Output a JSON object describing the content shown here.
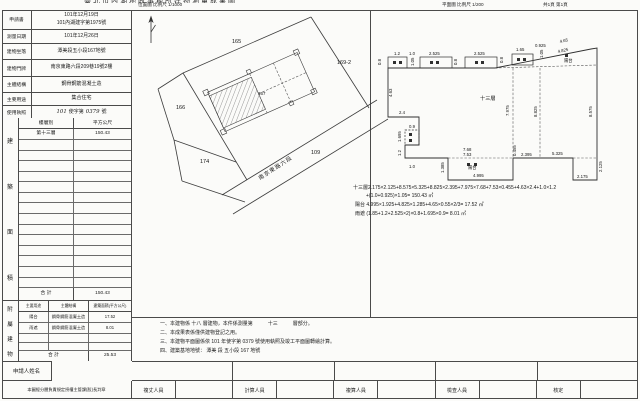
{
  "header": {
    "clipped_title": "臺北市內湖地政事務所建物測量成果圖",
    "location_map_title": "位置圖 比例尺 1/1000",
    "plan_title": "平面圖 比例尺 1/200",
    "page_info": "共1頁 第1頁"
  },
  "info": {
    "application": {
      "label": "申請書",
      "date": "101年12月19日",
      "doc_no": "101內湖建字第1975號"
    },
    "survey_date": {
      "label": "測量日期",
      "value": "101年12月26日"
    },
    "site": {
      "label": "建物坐落",
      "value": "潭美段五小段167地號"
    },
    "address": {
      "label": "建物門牌",
      "value": "南京東路六段209巷19號2樓"
    },
    "structure": {
      "label": "主體結構",
      "value": "鋼骨鋼筋混凝土造"
    },
    "usage": {
      "label": "主要用途",
      "value": "集合住宅"
    },
    "permit": {
      "label": "使用執照",
      "year": "101",
      "mid": "使字第",
      "no": "0379",
      "suffix": "號"
    }
  },
  "floor_area": {
    "side_label": "建築面積",
    "col_floor": "樓層別",
    "col_area": "平方公尺",
    "rows": [
      {
        "floor": "第十三層",
        "area": "150.43"
      }
    ],
    "empty_rows": 14,
    "total_label": "合 計",
    "total": "150.43"
  },
  "annex": {
    "side_label": "附屬建物",
    "headers": [
      "主要用途",
      "主體結構",
      "建築面積(平方公尺)"
    ],
    "rows": [
      [
        "陽台",
        "鋼骨鋼筋混凝土造",
        "17.52"
      ],
      [
        "雨遮",
        "鋼骨鋼筋混凝土造",
        "8.01"
      ],
      [
        "",
        "",
        ""
      ],
      [
        "",
        "",
        ""
      ]
    ],
    "total_label": "合 計",
    "total": "25.53"
  },
  "applicant_label": "申請人姓名",
  "approval_note": "本圖經分層負責規定授權主管課(股)長判章",
  "signers": [
    "複丈人員",
    "計算人員",
    "複算人員",
    "檢查人員",
    "核定"
  ],
  "notes": [
    "一、本建物係 十八 層建物，本件係測量第　　　十三　　　層部分。",
    "二、本成果表係僅供建物登記之用。",
    "三、本建物平面圖係依 101 年使字第 0379 號使用執照及竣工平面圖轉繪計算。",
    "四、建築基地地號： 潭美 段 五小段 167 地號"
  ],
  "location_map": {
    "labels": [
      {
        "t": "165",
        "x": 100,
        "y": 33,
        "cls": "maptxt"
      },
      {
        "t": "169-2",
        "x": 205,
        "y": 54,
        "cls": "maptxt"
      },
      {
        "t": "166",
        "x": 44,
        "y": 99,
        "cls": "maptxt"
      },
      {
        "t": "174",
        "x": 68,
        "y": 153,
        "cls": "maptxt"
      },
      {
        "t": "109",
        "x": 179,
        "y": 144,
        "cls": "maptxt"
      },
      {
        "t": "167",
        "x": 126,
        "y": 85,
        "cls": "sm"
      },
      {
        "t": "南京東路六段",
        "x": 128,
        "y": 170,
        "r": -33,
        "cls": "road"
      }
    ]
  },
  "floor_plan": {
    "labels": [
      {
        "t": "0.8",
        "x": 13,
        "y": 47,
        "r": -90
      },
      {
        "t": "1.2",
        "x": 26,
        "y": 37
      },
      {
        "t": "1.0",
        "x": 41,
        "y": 37
      },
      {
        "t": "1.05",
        "x": 46,
        "y": 48,
        "r": -90
      },
      {
        "t": "2.525",
        "x": 61,
        "y": 37
      },
      {
        "t": "0.8",
        "x": 89,
        "y": 47,
        "r": -90
      },
      {
        "t": "2.525",
        "x": 106,
        "y": 37
      },
      {
        "t": "0.8",
        "x": 135,
        "y": 45,
        "r": -90
      },
      {
        "t": "1.65",
        "x": 148,
        "y": 33
      },
      {
        "t": "0.925",
        "x": 167,
        "y": 29
      },
      {
        "t": "1.05",
        "x": 175,
        "y": 40,
        "r": -90
      },
      {
        "t": "4.65",
        "x": 192,
        "y": 25,
        "r": -12
      },
      {
        "t": "4.825",
        "x": 190,
        "y": 35,
        "r": -12
      },
      {
        "t": "陽台",
        "x": 196,
        "y": 44,
        "cls": "cj"
      },
      {
        "t": "8.575",
        "x": 224,
        "y": 99,
        "r": -90
      },
      {
        "t": "4.63",
        "x": 24,
        "y": 79,
        "r": -90
      },
      {
        "t": "2.4",
        "x": 31,
        "y": 96
      },
      {
        "t": "0.9",
        "x": 41,
        "y": 110
      },
      {
        "t": "1.695",
        "x": 33,
        "y": 124,
        "r": -90
      },
      {
        "t": "1.2",
        "x": 33,
        "y": 138,
        "r": -90
      },
      {
        "t": "1.0",
        "x": 41,
        "y": 150
      },
      {
        "t": "十三層",
        "x": 112,
        "y": 82,
        "cls": "big"
      },
      {
        "t": "7.975",
        "x": 141,
        "y": 98,
        "r": -90
      },
      {
        "t": "8.825",
        "x": 169,
        "y": 99,
        "r": -90
      },
      {
        "t": "1.385",
        "x": 76,
        "y": 155,
        "r": -90
      },
      {
        "t": "7.68",
        "x": 95,
        "y": 133
      },
      {
        "t": "7.53",
        "x": 95,
        "y": 138
      },
      {
        "t": "陽台",
        "x": 100,
        "y": 151,
        "cls": "cj"
      },
      {
        "t": "4.995",
        "x": 105,
        "y": 159
      },
      {
        "t": "0.455",
        "x": 148,
        "y": 138,
        "r": -90
      },
      {
        "t": "2.395",
        "x": 153,
        "y": 138
      },
      {
        "t": "5.325",
        "x": 184,
        "y": 137
      },
      {
        "t": "2.175",
        "x": 209,
        "y": 160
      },
      {
        "t": "2.125",
        "x": 234,
        "y": 154,
        "r": -90
      }
    ],
    "formulas": [
      "十三層2.175×2.125+8.575×5.325+8.825×2.395+7.975×7.68+7.53×0.455+4.63×2.4+1.0×1.2",
      "+(1.0+0.925)×1.05=  150.43  ㎡",
      "陽台 4.995×1.925+4.825×1.285+4.65×0.55×2/3=  17.52  ㎡",
      "雨遮 (1.85+1.2+2.525×2)×0.8+1.695×0.9=  8.01  ㎡"
    ]
  }
}
